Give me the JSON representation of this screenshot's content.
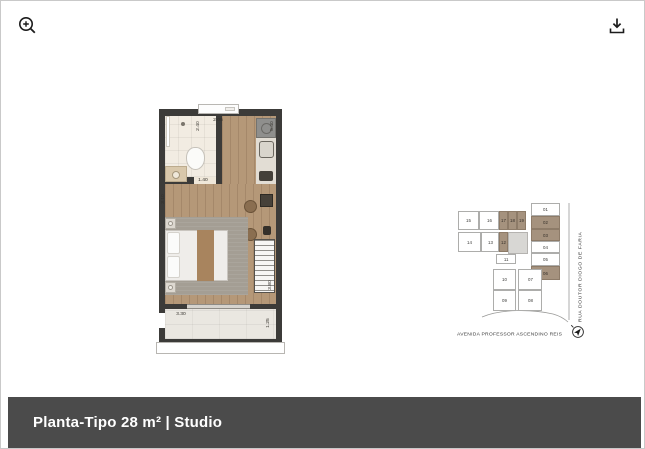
{
  "toolbar": {
    "zoom_icon": "zoom-in-magnifier",
    "download_icon": "download-tray-arrow"
  },
  "title_bar": {
    "label": "Planta-Tipo 28 m² | Studio",
    "background": "#4b4b4b",
    "text_color": "#ffffff"
  },
  "floorplan": {
    "unit_type": "Studio",
    "area": "28 m²",
    "dimensions": {
      "bath_width": "2.40",
      "top_width": "2.05",
      "bath_door": "1.40",
      "left_height": "3.10",
      "right_height_top": "5.40",
      "wardrobe_height": "3.80",
      "balcony_width": "3.30",
      "balcony_depth": "1.25"
    },
    "colors": {
      "wall": "#3c3b39",
      "wood_floor": "#b59878",
      "bath_floor": "#f2ece2",
      "balcony_floor": "#eae7e1"
    }
  },
  "keyplan": {
    "streets": {
      "bottom": "AVENIDA PROFESSOR ASCENDINO REIS",
      "right": "RUA DOUTOR DIOGO DE FARIA"
    },
    "highlight_color": "#a5927e",
    "compass_icon": "north-arrow",
    "units": [
      {
        "label": "15",
        "x": 2,
        "y": 10,
        "w": 21,
        "h": 19,
        "highlighted": false
      },
      {
        "label": "16",
        "x": 23,
        "y": 10,
        "w": 20,
        "h": 19,
        "highlighted": false
      },
      {
        "label": "17",
        "x": 43,
        "y": 10,
        "w": 9,
        "h": 19,
        "highlighted": true
      },
      {
        "label": "18",
        "x": 52,
        "y": 10,
        "w": 9,
        "h": 19,
        "highlighted": true
      },
      {
        "label": "19",
        "x": 61,
        "y": 10,
        "w": 9,
        "h": 19,
        "highlighted": true
      },
      {
        "label": "14",
        "x": 2,
        "y": 31,
        "w": 23,
        "h": 20,
        "highlighted": false
      },
      {
        "label": "13",
        "x": 25,
        "y": 31,
        "w": 18,
        "h": 20,
        "highlighted": false
      },
      {
        "label": "12",
        "x": 43,
        "y": 31,
        "w": 9,
        "h": 20,
        "highlighted": true
      },
      {
        "label": "11",
        "x": 40,
        "y": 53,
        "w": 20,
        "h": 10,
        "highlighted": false
      },
      {
        "label": "01",
        "x": 75,
        "y": 2,
        "w": 29,
        "h": 13,
        "highlighted": false
      },
      {
        "label": "02",
        "x": 75,
        "y": 15,
        "w": 29,
        "h": 13,
        "highlighted": true
      },
      {
        "label": "03",
        "x": 75,
        "y": 28,
        "w": 29,
        "h": 12,
        "highlighted": true
      },
      {
        "label": "04",
        "x": 75,
        "y": 40,
        "w": 29,
        "h": 12,
        "highlighted": false
      },
      {
        "label": "05",
        "x": 75,
        "y": 52,
        "w": 29,
        "h": 13,
        "highlighted": false
      },
      {
        "label": "06",
        "x": 75,
        "y": 65,
        "w": 29,
        "h": 14,
        "highlighted": true
      },
      {
        "label": "10",
        "x": 37,
        "y": 68,
        "w": 23,
        "h": 21,
        "highlighted": false
      },
      {
        "label": "07",
        "x": 62,
        "y": 68,
        "w": 24,
        "h": 21,
        "highlighted": false
      },
      {
        "label": "09",
        "x": 37,
        "y": 89,
        "w": 23,
        "h": 21,
        "highlighted": false
      },
      {
        "label": "08",
        "x": 62,
        "y": 89,
        "w": 24,
        "h": 21,
        "highlighted": false
      }
    ]
  }
}
